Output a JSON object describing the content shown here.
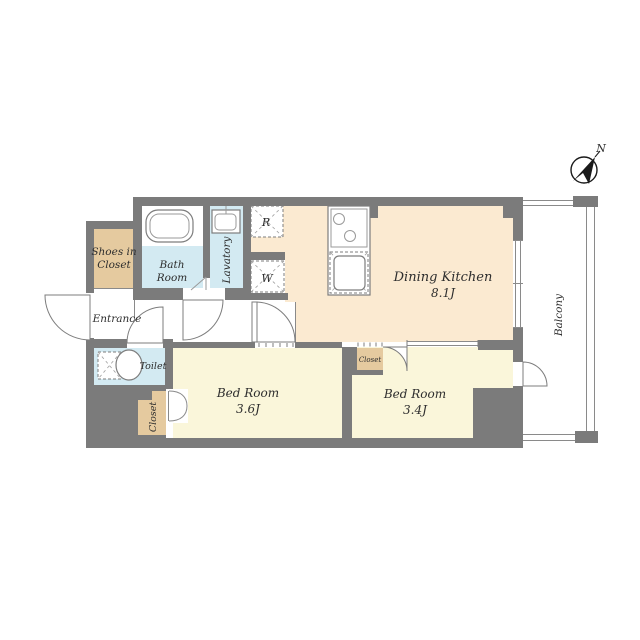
{
  "compass": {
    "north": "N"
  },
  "rooms": {
    "dining_kitchen": {
      "label": "Dining Kitchen",
      "area": "8.1J"
    },
    "bedroom_36": {
      "label": "Bed Room",
      "area": "3.6J"
    },
    "bedroom_34": {
      "label": "Bed Room",
      "area": "3.4J"
    },
    "bathroom": {
      "label_line1": "Bath",
      "label_line2": "Room"
    },
    "lavatory": {
      "label": "Lavatory"
    },
    "toilet": {
      "label": "Toilet"
    },
    "entrance": {
      "label": "Entrance"
    },
    "shoes_in_closet": {
      "label_line1": "Shoes in",
      "label_line2": "Closet"
    },
    "closet_bedroom_36": {
      "label": "Closet"
    },
    "closet_bedroom_34": {
      "label": "Closet"
    },
    "balcony": {
      "label": "Balcony"
    }
  },
  "appliances": {
    "refrigerator_mark": "R",
    "washer_mark": "W"
  },
  "colors": {
    "wall": "#7b7b7b",
    "dining_kitchen_floor": "#fbead1",
    "bedroom_floor": "#faf6da",
    "closet_fill": "#e5ca9f",
    "wet_area_fill": "#d3eaf2",
    "thin_line": "#8a8a8a"
  }
}
